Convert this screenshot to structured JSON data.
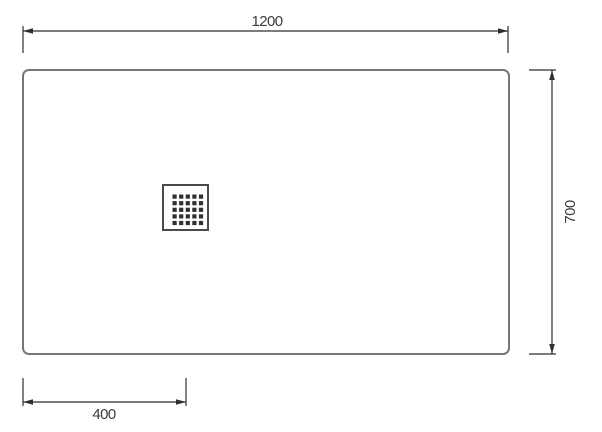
{
  "diagram": {
    "type": "technical-drawing",
    "subject": "shower-tray-top-view",
    "dimensions": {
      "width": {
        "label": "1200"
      },
      "height": {
        "label": "700"
      },
      "drain_offset": {
        "label": "400"
      }
    },
    "drain": {
      "rows": 5,
      "cols": 5
    },
    "colors": {
      "background": "#ffffff",
      "outline": "#767676",
      "dimension": "#2e2e2e",
      "text": "#3c3c3c",
      "drain_outline": "#4a4a4a",
      "drain_hole": "#2f2f2f"
    }
  }
}
